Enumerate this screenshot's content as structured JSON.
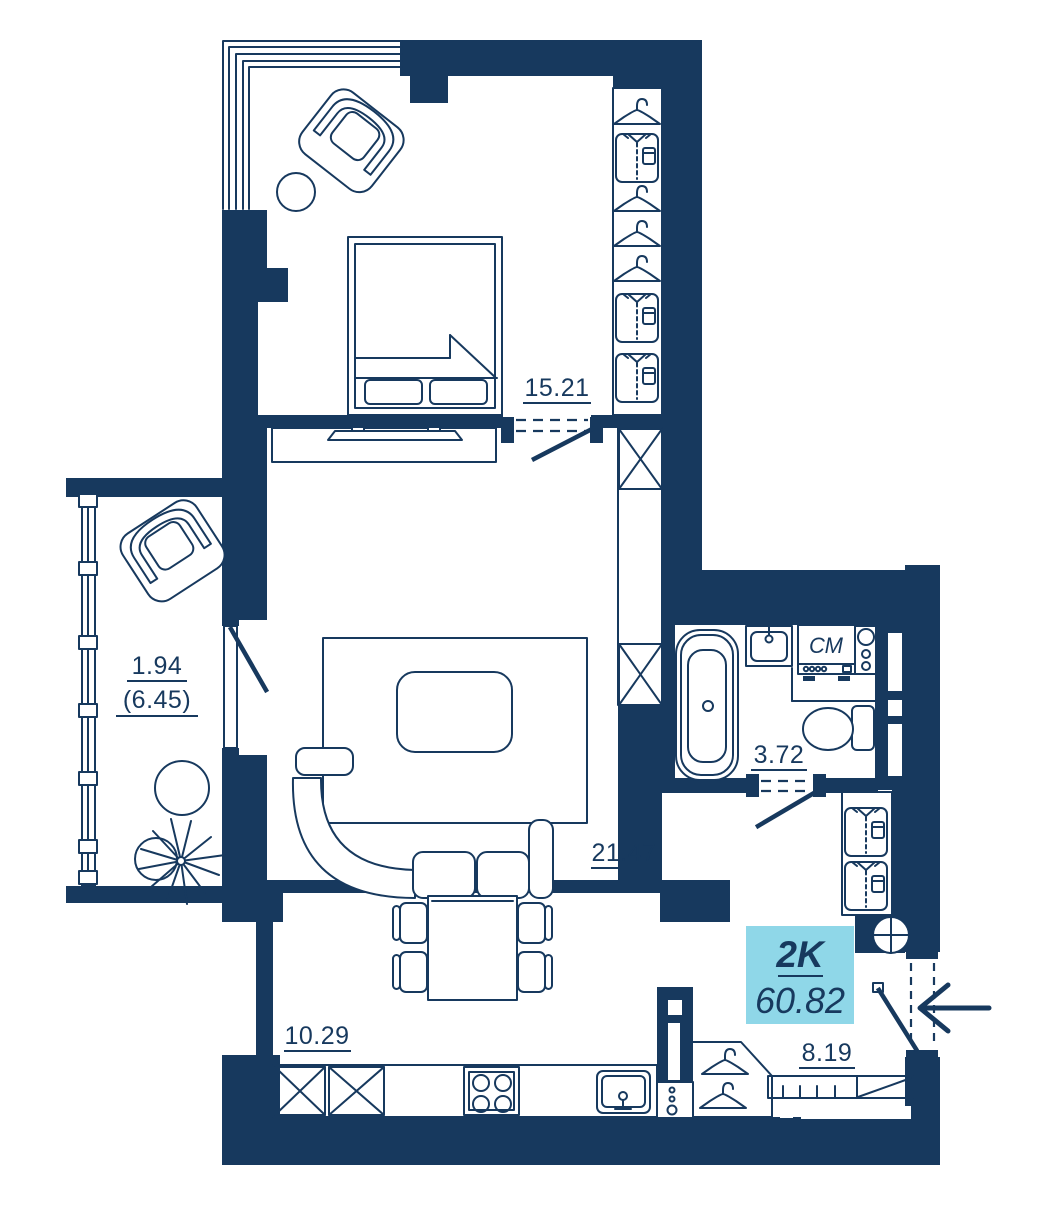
{
  "colors": {
    "wall": "#17395E",
    "line": "#17395E",
    "background": "#FFFFFF",
    "area_badge_bg": "#8FD7E8"
  },
  "unit_card": {
    "type": "2K",
    "total_area": "60.82"
  },
  "rooms": {
    "bedroom": {
      "area": "15.21"
    },
    "living_room": {
      "area": "21.47"
    },
    "balcony": {
      "area_counted": "1.94",
      "area_total": "(6.45)"
    },
    "bathroom": {
      "area": "3.72"
    },
    "kitchen": {
      "area": "10.29"
    },
    "hallway": {
      "area": "8.19"
    }
  },
  "appliances": {
    "washing_machine_label": "СМ"
  },
  "icons": {
    "bedroom_wardrobe": [
      "hanger-icon",
      "shirt-icon",
      "hanger-icon",
      "hanger-icon",
      "hanger-icon",
      "shirt-icon",
      "shirt-icon"
    ],
    "hallway_wardrobe": [
      "shirt-icon",
      "shirt-icon"
    ],
    "hallway_hooks": [
      "hanger-icon",
      "hanger-icon"
    ],
    "ventilation": "vent-cross-icon",
    "entrance": "entrance-arrow-icon"
  }
}
